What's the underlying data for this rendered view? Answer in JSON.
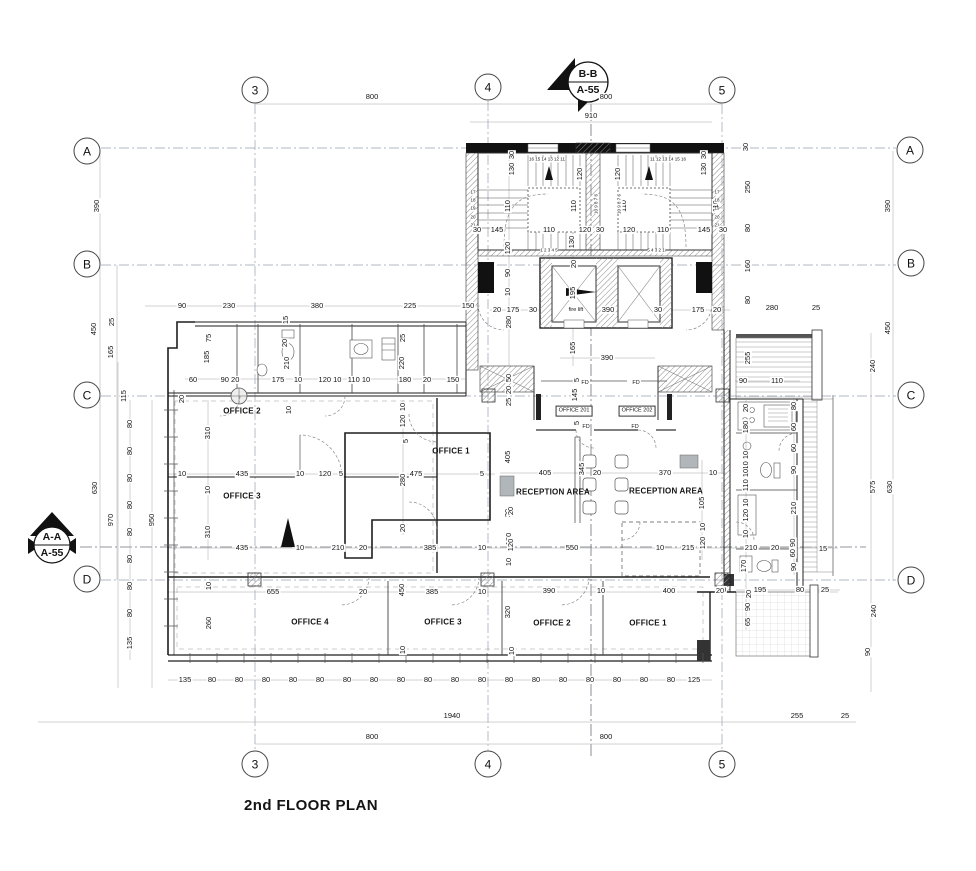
{
  "title": "2nd FLOOR PLAN",
  "grid_bubbles": [
    {
      "t": "3",
      "x": 255,
      "y": 90
    },
    {
      "t": "4",
      "x": 488,
      "y": 87
    },
    {
      "t": "5",
      "x": 722,
      "y": 90
    },
    {
      "t": "3",
      "x": 255,
      "y": 764
    },
    {
      "t": "4",
      "x": 488,
      "y": 764
    },
    {
      "t": "5",
      "x": 722,
      "y": 764
    },
    {
      "t": "A",
      "x": 87,
      "y": 151
    },
    {
      "t": "B",
      "x": 87,
      "y": 264
    },
    {
      "t": "C",
      "x": 87,
      "y": 395
    },
    {
      "t": "D",
      "x": 87,
      "y": 579
    },
    {
      "t": "A",
      "x": 910,
      "y": 150
    },
    {
      "t": "B",
      "x": 911,
      "y": 263
    },
    {
      "t": "C",
      "x": 911,
      "y": 395
    },
    {
      "t": "D",
      "x": 911,
      "y": 580
    }
  ],
  "labels": [
    {
      "t": "800",
      "x": 372,
      "y": 97
    },
    {
      "t": "800",
      "x": 606,
      "y": 97
    },
    {
      "t": "910",
      "x": 591,
      "y": 116
    },
    {
      "t": "B-B",
      "x": 588,
      "y": 75,
      "c": "m"
    },
    {
      "t": "A-55",
      "x": 588,
      "y": 91,
      "c": "m"
    },
    {
      "t": "A-A",
      "x": 52,
      "y": 538,
      "c": "m"
    },
    {
      "t": "A-55",
      "x": 52,
      "y": 554,
      "c": "m"
    },
    {
      "t": "30",
      "x": 512,
      "y": 155,
      "c": "v"
    },
    {
      "t": "130",
      "x": 512,
      "y": 169,
      "c": "v"
    },
    {
      "t": "30",
      "x": 704,
      "y": 155,
      "c": "v"
    },
    {
      "t": "130",
      "x": 704,
      "y": 169,
      "c": "v"
    },
    {
      "t": "120",
      "x": 580,
      "y": 174,
      "c": "v"
    },
    {
      "t": "120",
      "x": 618,
      "y": 174,
      "c": "v"
    },
    {
      "t": "110",
      "x": 508,
      "y": 206,
      "c": "v"
    },
    {
      "t": "110",
      "x": 574,
      "y": 206,
      "c": "v"
    },
    {
      "t": "110",
      "x": 624,
      "y": 206,
      "c": "v"
    },
    {
      "t": "110",
      "x": 716,
      "y": 206,
      "c": "v"
    },
    {
      "t": "16 15 14 13 12 11",
      "x": 547,
      "y": 160,
      "c": "t"
    },
    {
      "t": "11 12 13 14 15 16",
      "x": 668,
      "y": 160,
      "c": "t"
    },
    {
      "t": "17",
      "x": 473,
      "y": 193,
      "c": "t"
    },
    {
      "t": "18",
      "x": 473,
      "y": 201,
      "c": "t"
    },
    {
      "t": "19",
      "x": 473,
      "y": 209,
      "c": "t"
    },
    {
      "t": "20",
      "x": 473,
      "y": 218,
      "c": "t"
    },
    {
      "t": "21",
      "x": 473,
      "y": 226,
      "c": "t"
    },
    {
      "t": "17",
      "x": 717,
      "y": 193,
      "c": "t"
    },
    {
      "t": "18",
      "x": 717,
      "y": 201,
      "c": "t"
    },
    {
      "t": "19",
      "x": 717,
      "y": 209,
      "c": "t"
    },
    {
      "t": "20",
      "x": 717,
      "y": 218,
      "c": "t"
    },
    {
      "t": "21",
      "x": 717,
      "y": 226,
      "c": "t"
    },
    {
      "t": "10 9 8 7 6",
      "x": 597,
      "y": 204,
      "c": "tv"
    },
    {
      "t": "10 9 8 7 6",
      "x": 620,
      "y": 204,
      "c": "tv"
    },
    {
      "t": "1 2 3 4 5",
      "x": 549,
      "y": 251,
      "c": "t"
    },
    {
      "t": "5 4 3 2 1",
      "x": 656,
      "y": 251,
      "c": "t"
    },
    {
      "t": "30",
      "x": 477,
      "y": 230
    },
    {
      "t": "145",
      "x": 497,
      "y": 230
    },
    {
      "t": "110",
      "x": 549,
      "y": 230
    },
    {
      "t": "130",
      "x": 572,
      "y": 242,
      "c": "v"
    },
    {
      "t": "120",
      "x": 585,
      "y": 230
    },
    {
      "t": "30",
      "x": 600,
      "y": 230
    },
    {
      "t": "120",
      "x": 629,
      "y": 230
    },
    {
      "t": "110",
      "x": 663,
      "y": 230
    },
    {
      "t": "145",
      "x": 704,
      "y": 230
    },
    {
      "t": "30",
      "x": 723,
      "y": 230
    },
    {
      "t": "120",
      "x": 508,
      "y": 248,
      "c": "v"
    },
    {
      "t": "90",
      "x": 508,
      "y": 273,
      "c": "v"
    },
    {
      "t": "10",
      "x": 508,
      "y": 292,
      "c": "v"
    },
    {
      "t": "20",
      "x": 574,
      "y": 264,
      "c": "v"
    },
    {
      "t": "195",
      "x": 573,
      "y": 293,
      "c": "v"
    },
    {
      "t": "fire lift",
      "x": 576,
      "y": 310,
      "c": "s"
    },
    {
      "t": "390",
      "x": 608,
      "y": 310
    },
    {
      "t": "30",
      "x": 658,
      "y": 310
    },
    {
      "t": "20",
      "x": 497,
      "y": 310
    },
    {
      "t": "175",
      "x": 513,
      "y": 310
    },
    {
      "t": "30",
      "x": 533,
      "y": 310
    },
    {
      "t": "175",
      "x": 698,
      "y": 310
    },
    {
      "t": "20",
      "x": 717,
      "y": 310
    },
    {
      "t": "280",
      "x": 509,
      "y": 322,
      "c": "v"
    },
    {
      "t": "165",
      "x": 573,
      "y": 348,
      "c": "v"
    },
    {
      "t": "390",
      "x": 607,
      "y": 358
    },
    {
      "t": "30",
      "x": 746,
      "y": 147,
      "c": "v"
    },
    {
      "t": "250",
      "x": 748,
      "y": 187,
      "c": "v"
    },
    {
      "t": "80",
      "x": 748,
      "y": 228,
      "c": "v"
    },
    {
      "t": "160",
      "x": 748,
      "y": 266,
      "c": "v"
    },
    {
      "t": "80",
      "x": 748,
      "y": 300,
      "c": "v"
    },
    {
      "t": "280",
      "x": 772,
      "y": 308
    },
    {
      "t": "25",
      "x": 816,
      "y": 308
    },
    {
      "t": "255",
      "x": 748,
      "y": 358,
      "c": "v"
    },
    {
      "t": "90",
      "x": 743,
      "y": 381
    },
    {
      "t": "110",
      "x": 777,
      "y": 381
    },
    {
      "t": "90",
      "x": 182,
      "y": 306
    },
    {
      "t": "230",
      "x": 229,
      "y": 306
    },
    {
      "t": "380",
      "x": 317,
      "y": 306
    },
    {
      "t": "225",
      "x": 410,
      "y": 306
    },
    {
      "t": "150",
      "x": 468,
      "y": 306
    },
    {
      "t": "450",
      "x": 94,
      "y": 329,
      "c": "v"
    },
    {
      "t": "25",
      "x": 112,
      "y": 322,
      "c": "v"
    },
    {
      "t": "165",
      "x": 111,
      "y": 352,
      "c": "v"
    },
    {
      "t": "115",
      "x": 124,
      "y": 396,
      "c": "v"
    },
    {
      "t": "75",
      "x": 209,
      "y": 338,
      "c": "v"
    },
    {
      "t": "185",
      "x": 207,
      "y": 357,
      "c": "v"
    },
    {
      "t": "15",
      "x": 286,
      "y": 320,
      "c": "v"
    },
    {
      "t": "20",
      "x": 285,
      "y": 343,
      "c": "v"
    },
    {
      "t": "210",
      "x": 287,
      "y": 363,
      "c": "v"
    },
    {
      "t": "25",
      "x": 403,
      "y": 338,
      "c": "v"
    },
    {
      "t": "220",
      "x": 402,
      "y": 363,
      "c": "v"
    },
    {
      "t": "60",
      "x": 193,
      "y": 380
    },
    {
      "t": "90 20",
      "x": 230,
      "y": 380
    },
    {
      "t": "175",
      "x": 278,
      "y": 380
    },
    {
      "t": "10",
      "x": 298,
      "y": 380
    },
    {
      "t": "120 10",
      "x": 330,
      "y": 380
    },
    {
      "t": "110 10",
      "x": 359,
      "y": 380
    },
    {
      "t": "180",
      "x": 405,
      "y": 380
    },
    {
      "t": "20",
      "x": 427,
      "y": 380
    },
    {
      "t": "150",
      "x": 453,
      "y": 380
    },
    {
      "t": "20",
      "x": 182,
      "y": 399,
      "c": "v"
    },
    {
      "t": "10",
      "x": 289,
      "y": 410,
      "c": "v"
    },
    {
      "t": "OFFICE 2",
      "x": 242,
      "y": 412,
      "c": "r"
    },
    {
      "t": "310",
      "x": 208,
      "y": 433,
      "c": "v"
    },
    {
      "t": "10",
      "x": 403,
      "y": 407,
      "c": "v"
    },
    {
      "t": "120",
      "x": 403,
      "y": 421,
      "c": "v"
    },
    {
      "t": "5",
      "x": 406,
      "y": 441,
      "c": "v"
    },
    {
      "t": "OFFICE 1",
      "x": 451,
      "y": 452,
      "c": "r"
    },
    {
      "t": "405",
      "x": 508,
      "y": 457,
      "c": "v"
    },
    {
      "t": "10",
      "x": 182,
      "y": 474
    },
    {
      "t": "435",
      "x": 242,
      "y": 474
    },
    {
      "t": "10",
      "x": 300,
      "y": 474
    },
    {
      "t": "120",
      "x": 325,
      "y": 474
    },
    {
      "t": "5",
      "x": 341,
      "y": 474
    },
    {
      "t": "280",
      "x": 403,
      "y": 480,
      "c": "v"
    },
    {
      "t": "475",
      "x": 416,
      "y": 474
    },
    {
      "t": "5",
      "x": 482,
      "y": 474
    },
    {
      "t": "10",
      "x": 208,
      "y": 490,
      "c": "v"
    },
    {
      "t": "OFFICE 3",
      "x": 242,
      "y": 497,
      "c": "r"
    },
    {
      "t": "310",
      "x": 208,
      "y": 532,
      "c": "v"
    },
    {
      "t": "20",
      "x": 508,
      "y": 513,
      "c": "v"
    },
    {
      "t": "120",
      "x": 509,
      "y": 539,
      "c": "v"
    },
    {
      "t": "10",
      "x": 509,
      "y": 562,
      "c": "v"
    },
    {
      "t": "435",
      "x": 242,
      "y": 548
    },
    {
      "t": "10",
      "x": 300,
      "y": 548
    },
    {
      "t": "210",
      "x": 338,
      "y": 548
    },
    {
      "t": "20",
      "x": 363,
      "y": 548
    },
    {
      "t": "385",
      "x": 430,
      "y": 548
    },
    {
      "t": "10",
      "x": 482,
      "y": 548
    },
    {
      "t": "20",
      "x": 403,
      "y": 528,
      "c": "v"
    },
    {
      "t": "50",
      "x": 509,
      "y": 378,
      "c": "v"
    },
    {
      "t": "20",
      "x": 509,
      "y": 390,
      "c": "v"
    },
    {
      "t": "25",
      "x": 509,
      "y": 402,
      "c": "v"
    },
    {
      "t": "5",
      "x": 577,
      "y": 380,
      "c": "v"
    },
    {
      "t": "145",
      "x": 575,
      "y": 395,
      "c": "v"
    },
    {
      "t": "5",
      "x": 577,
      "y": 423,
      "c": "v"
    },
    {
      "t": "FD",
      "x": 585,
      "y": 383,
      "c": "s"
    },
    {
      "t": "FD",
      "x": 636,
      "y": 383,
      "c": "s"
    },
    {
      "t": "FD",
      "x": 586,
      "y": 427,
      "c": "s"
    },
    {
      "t": "FD",
      "x": 635,
      "y": 427,
      "c": "s"
    },
    {
      "t": "OFFICE 201",
      "x": 574,
      "y": 411,
      "c": "b"
    },
    {
      "t": "OFFICE 202",
      "x": 637,
      "y": 411,
      "c": "b"
    },
    {
      "t": "405",
      "x": 545,
      "y": 473
    },
    {
      "t": "345",
      "x": 582,
      "y": 469,
      "c": "v"
    },
    {
      "t": "20",
      "x": 597,
      "y": 473
    },
    {
      "t": "370",
      "x": 665,
      "y": 473
    },
    {
      "t": "10",
      "x": 713,
      "y": 473
    },
    {
      "t": "RECEPTION AREA",
      "x": 553,
      "y": 493,
      "c": "r"
    },
    {
      "t": "RECEPTION AREA",
      "x": 666,
      "y": 492,
      "c": "r"
    },
    {
      "t": "20",
      "x": 511,
      "y": 511,
      "c": "v"
    },
    {
      "t": "105",
      "x": 702,
      "y": 503,
      "c": "v"
    },
    {
      "t": "120",
      "x": 511,
      "y": 545,
      "c": "v"
    },
    {
      "t": "550",
      "x": 572,
      "y": 548
    },
    {
      "t": "10",
      "x": 660,
      "y": 548
    },
    {
      "t": "215",
      "x": 688,
      "y": 548
    },
    {
      "t": "10",
      "x": 703,
      "y": 527,
      "c": "v"
    },
    {
      "t": "120",
      "x": 703,
      "y": 543,
      "c": "v"
    },
    {
      "t": "210",
      "x": 751,
      "y": 548
    },
    {
      "t": "20",
      "x": 775,
      "y": 548
    },
    {
      "t": "20",
      "x": 746,
      "y": 408,
      "c": "v"
    },
    {
      "t": "180",
      "x": 746,
      "y": 427,
      "c": "v"
    },
    {
      "t": "110 10",
      "x": 746,
      "y": 462,
      "c": "v"
    },
    {
      "t": "110 10",
      "x": 746,
      "y": 480,
      "c": "v"
    },
    {
      "t": "120 10",
      "x": 746,
      "y": 510,
      "c": "v"
    },
    {
      "t": "10",
      "x": 746,
      "y": 534,
      "c": "v"
    },
    {
      "t": "170",
      "x": 744,
      "y": 566,
      "c": "v"
    },
    {
      "t": "80",
      "x": 794,
      "y": 406,
      "c": "v"
    },
    {
      "t": "60",
      "x": 794,
      "y": 427,
      "c": "v"
    },
    {
      "t": "60",
      "x": 794,
      "y": 448,
      "c": "v"
    },
    {
      "t": "90",
      "x": 794,
      "y": 470,
      "c": "v"
    },
    {
      "t": "210",
      "x": 794,
      "y": 508,
      "c": "v"
    },
    {
      "t": "60 90",
      "x": 793,
      "y": 548,
      "c": "v"
    },
    {
      "t": "90",
      "x": 794,
      "y": 567,
      "c": "v"
    },
    {
      "t": "15",
      "x": 823,
      "y": 549
    },
    {
      "t": "20",
      "x": 722,
      "y": 590
    },
    {
      "t": "195",
      "x": 760,
      "y": 590
    },
    {
      "t": "80",
      "x": 800,
      "y": 590
    },
    {
      "t": "25",
      "x": 825,
      "y": 590
    },
    {
      "t": "20",
      "x": 749,
      "y": 594,
      "c": "v"
    },
    {
      "t": "90",
      "x": 748,
      "y": 607,
      "c": "v"
    },
    {
      "t": "65",
      "x": 748,
      "y": 622,
      "c": "v"
    },
    {
      "t": "390",
      "x": 888,
      "y": 206,
      "c": "v"
    },
    {
      "t": "450",
      "x": 888,
      "y": 328,
      "c": "v"
    },
    {
      "t": "240",
      "x": 873,
      "y": 366,
      "c": "v"
    },
    {
      "t": "575",
      "x": 873,
      "y": 487,
      "c": "v"
    },
    {
      "t": "630",
      "x": 890,
      "y": 487,
      "c": "v"
    },
    {
      "t": "240",
      "x": 874,
      "y": 611,
      "c": "v"
    },
    {
      "t": "90",
      "x": 868,
      "y": 652,
      "c": "v"
    },
    {
      "t": "390",
      "x": 97,
      "y": 206,
      "c": "v"
    },
    {
      "t": "630",
      "x": 95,
      "y": 488,
      "c": "v"
    },
    {
      "t": "970",
      "x": 111,
      "y": 520,
      "c": "v"
    },
    {
      "t": "950",
      "x": 152,
      "y": 520,
      "c": "v"
    },
    {
      "t": "80",
      "x": 130,
      "y": 424,
      "c": "v",
      "n": 8,
      "dy": 27
    },
    {
      "t": "135",
      "x": 130,
      "y": 643,
      "c": "v"
    },
    {
      "t": "10",
      "x": 209,
      "y": 586,
      "c": "v"
    },
    {
      "t": "655",
      "x": 273,
      "y": 592
    },
    {
      "t": "20",
      "x": 363,
      "y": 592
    },
    {
      "t": "450",
      "x": 402,
      "y": 590,
      "c": "v"
    },
    {
      "t": "385",
      "x": 432,
      "y": 592
    },
    {
      "t": "10",
      "x": 482,
      "y": 592
    },
    {
      "t": "390",
      "x": 549,
      "y": 591
    },
    {
      "t": "10",
      "x": 601,
      "y": 591
    },
    {
      "t": "400",
      "x": 669,
      "y": 591
    },
    {
      "t": "20",
      "x": 720,
      "y": 591
    },
    {
      "t": "260",
      "x": 209,
      "y": 623,
      "c": "v"
    },
    {
      "t": "320",
      "x": 508,
      "y": 612,
      "c": "v"
    },
    {
      "t": "OFFICE 4",
      "x": 310,
      "y": 623,
      "c": "r"
    },
    {
      "t": "OFFICE 3",
      "x": 443,
      "y": 623,
      "c": "r"
    },
    {
      "t": "OFFICE 2",
      "x": 552,
      "y": 624,
      "c": "r"
    },
    {
      "t": "OFFICE 1",
      "x": 648,
      "y": 624,
      "c": "r"
    },
    {
      "t": "10",
      "x": 403,
      "y": 650,
      "c": "v"
    },
    {
      "t": "10",
      "x": 512,
      "y": 651,
      "c": "v"
    },
    {
      "t": "135",
      "x": 185,
      "y": 680
    },
    {
      "t": "80",
      "x": 212,
      "y": 680,
      "n": 18,
      "dx": 27
    },
    {
      "t": "125",
      "x": 694,
      "y": 680
    },
    {
      "t": "1940",
      "x": 452,
      "y": 716
    },
    {
      "t": "255",
      "x": 797,
      "y": 716
    },
    {
      "t": "25",
      "x": 845,
      "y": 716
    },
    {
      "t": "800",
      "x": 372,
      "y": 737
    },
    {
      "t": "800",
      "x": 606,
      "y": 737
    }
  ]
}
